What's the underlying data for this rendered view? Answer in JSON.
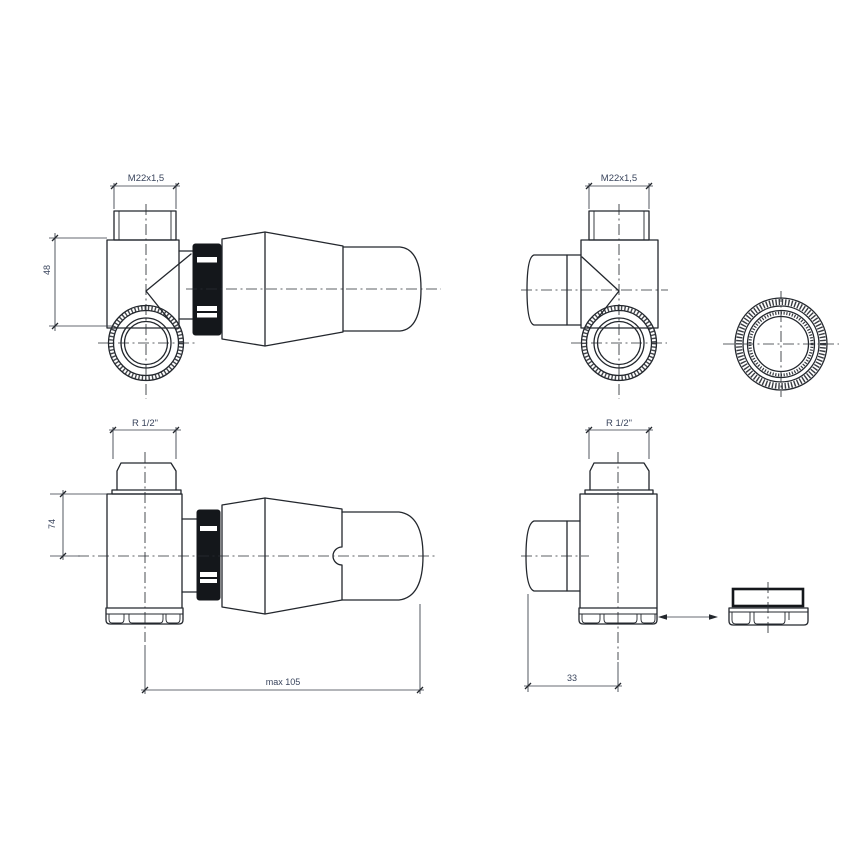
{
  "drawing": {
    "line_color": "#23272d",
    "dim_text_color": "#39445c",
    "views": {
      "top_left": {
        "thread_label": "M22x1,5",
        "height_dim": "48"
      },
      "top_right": {
        "thread_label": "M22x1,5"
      },
      "bottom_left": {
        "thread_label": "R 1/2\"",
        "height_dim": "74",
        "length_dim": "max 105"
      },
      "bottom_right": {
        "thread_label": "R 1/2\"",
        "offset_dim": "33"
      }
    }
  }
}
